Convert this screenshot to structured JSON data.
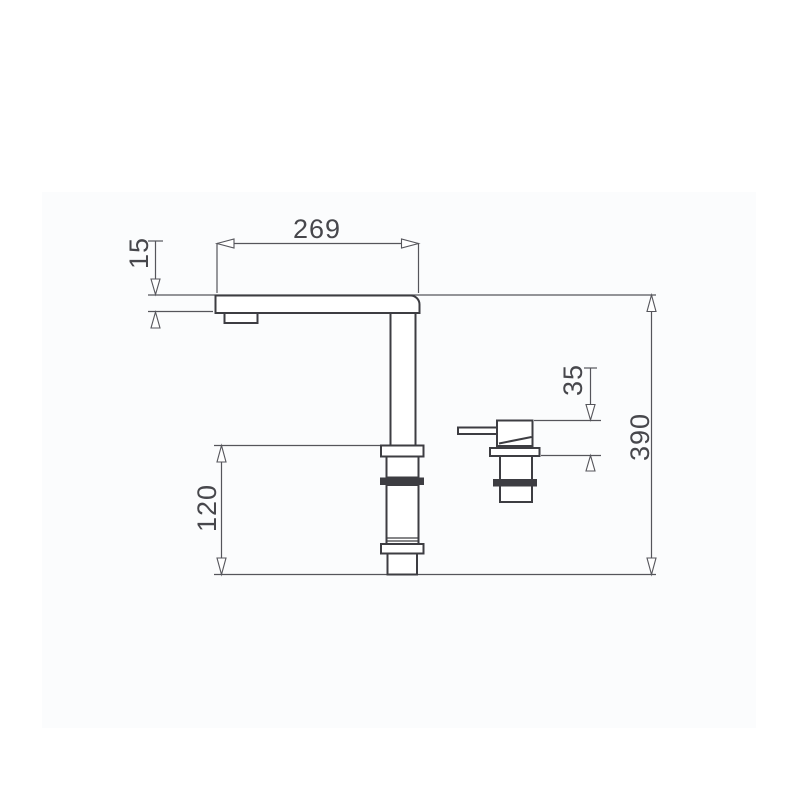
{
  "drawing": {
    "title": "Single-lever kitchen faucet with side handle - dimensioned side view",
    "colors": {
      "background": "#ffffff",
      "panel": "#fbfcfd",
      "outline": "#3d3d42",
      "dimension_lines": "#55555b",
      "dimension_text": "#47474c"
    },
    "dimensions": {
      "spout_reach": "269",
      "spout_height": "15",
      "base_height": "120",
      "handle_height": "35",
      "total_height": "390"
    }
  }
}
